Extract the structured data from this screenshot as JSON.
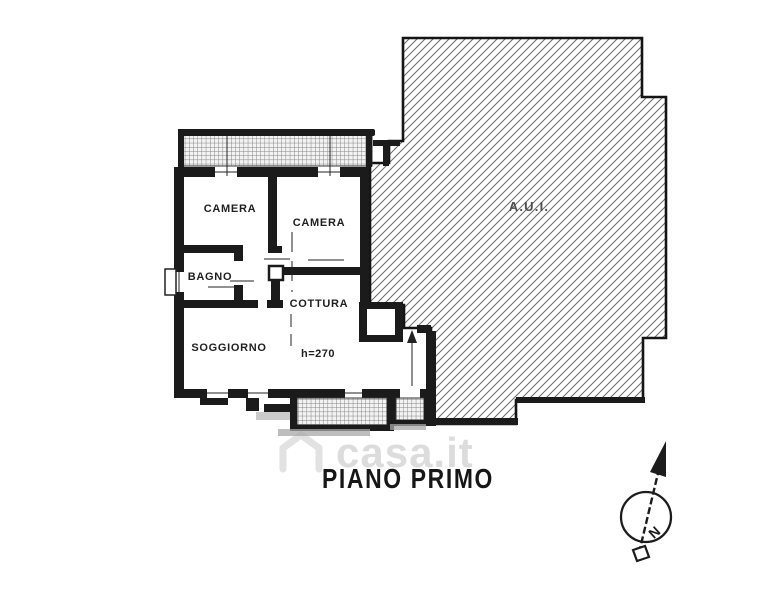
{
  "title": "PIANO PRIMO",
  "plan": {
    "rooms": [
      {
        "id": "camera-1",
        "label": "CAMERA"
      },
      {
        "id": "camera-2",
        "label": "CAMERA"
      },
      {
        "id": "bagno",
        "label": "BAGNO"
      },
      {
        "id": "cottura",
        "label": "COTTURA"
      },
      {
        "id": "soggiorno",
        "label": "SOGGIORNO"
      },
      {
        "id": "aui",
        "label": "A.U.I."
      }
    ],
    "annotations": {
      "ceiling_height": "h=270"
    },
    "compass": {
      "north_label": "N"
    }
  },
  "watermark": {
    "text": "casa.it",
    "icon": "house-icon"
  },
  "colors": {
    "background": "#ffffff",
    "wall": "#1b1b1b",
    "diagonal_hatch": "#6a6a6a",
    "grid_hatch": "#7e7e7e",
    "shadow": "#a8a8a8",
    "room_label": "#1f1f1f",
    "aui_label": "#4f4f4f",
    "title": "#161616",
    "watermark": "#dcdcdc"
  }
}
